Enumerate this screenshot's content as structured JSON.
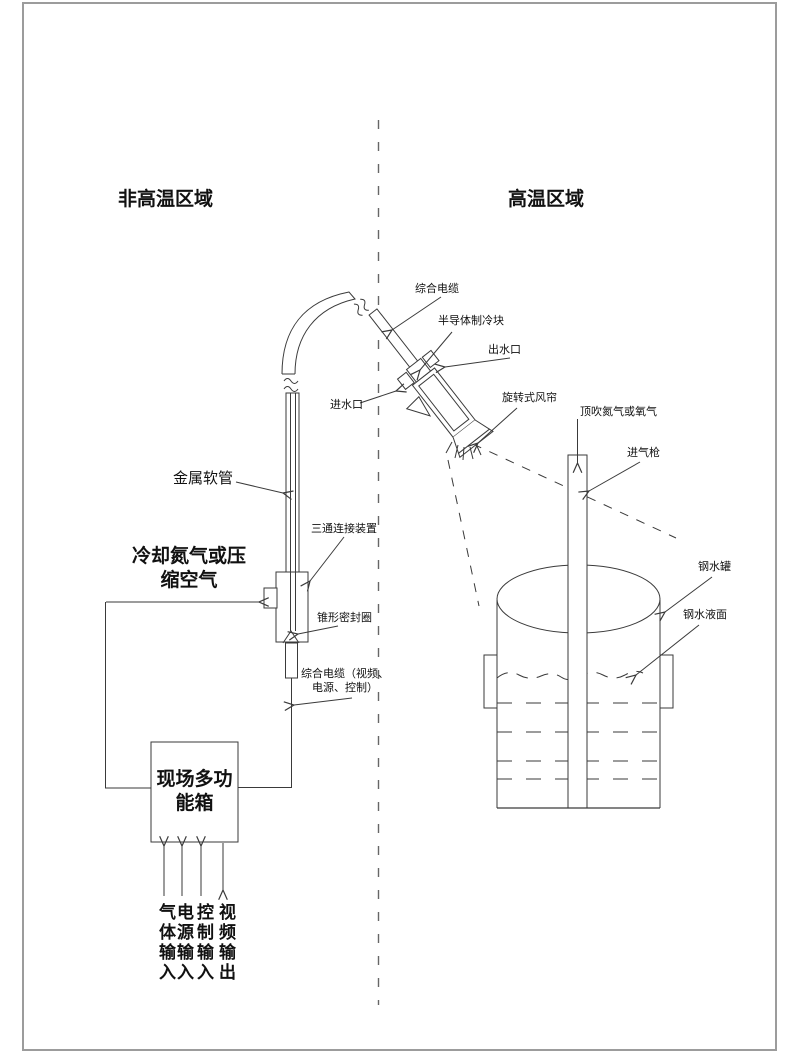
{
  "page": {
    "background": "#ffffff",
    "frame_color": "#9c9c9c",
    "line_color": "#3a3a3a",
    "divider_style": "dashed"
  },
  "regions": {
    "left_title": "非高温区域",
    "right_title": "高温区域"
  },
  "labels": {
    "integrated_cable": "综合电缆",
    "semiconductor_cooler": "半导体制冷块",
    "water_outlet": "出水口",
    "water_inlet": "进水口",
    "rotary_air_curtain": "旋转式风帘",
    "top_blow_gas": "顶吹氮气或氧气",
    "gas_lance": "进气枪",
    "metal_hose": "金属软管",
    "tee_connector": "三通连接装置",
    "cooling_gas_line1": "冷却氮气或压",
    "cooling_gas_line2": "缩空气",
    "conical_seal": "锥形密封圈",
    "integrated_cable_full_line1": "综合电缆（视频、",
    "integrated_cable_full_line2": "电源、控制）",
    "molten_steel_tank": "钢水罐",
    "molten_steel_surface": "钢水液面",
    "field_box_line1": "现场多功",
    "field_box_line2": "能箱"
  },
  "io_ports": [
    {
      "label": "气体输入",
      "direction": "in"
    },
    {
      "label": "电源输入",
      "direction": "in"
    },
    {
      "label": "控制输入",
      "direction": "in"
    },
    {
      "label": "视频输出",
      "direction": "out"
    }
  ]
}
